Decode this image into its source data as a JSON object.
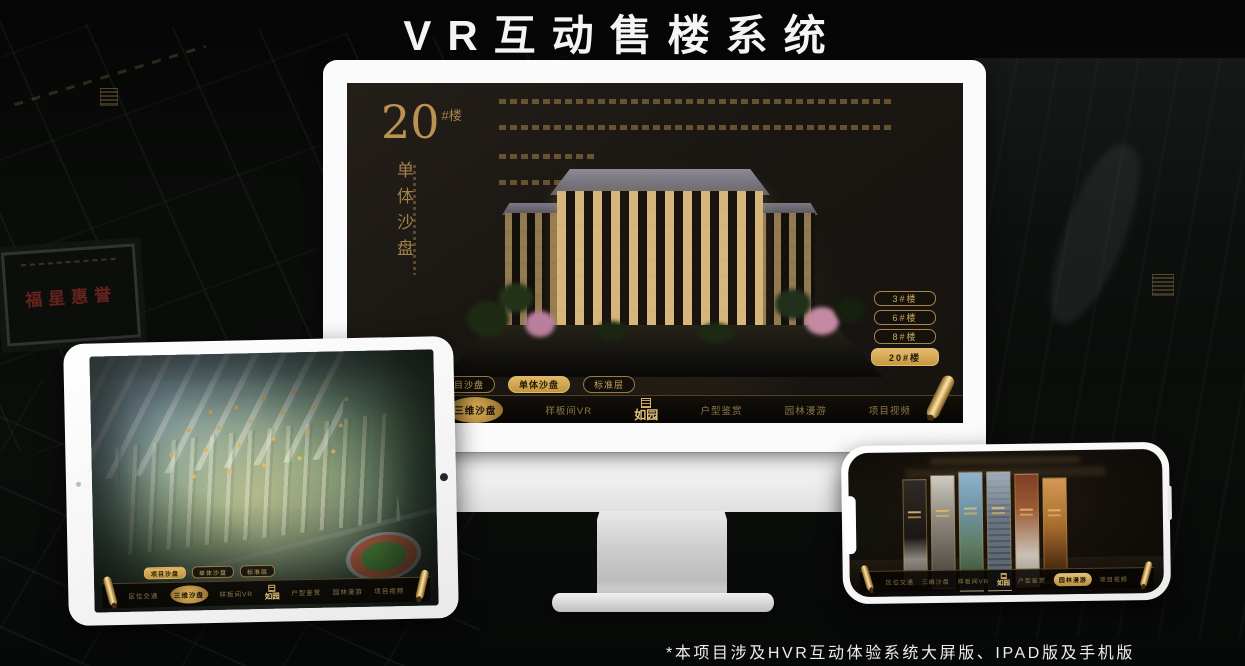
{
  "page": {
    "title": "VR互动售楼系统",
    "footnote": "*本项目涉及HVR互动体验系统大屏版、IPAD版及手机版"
  },
  "colors": {
    "gold": "#d9a84e",
    "gold_text": "#c9a158",
    "screen_bg": "#1b1713",
    "device_white": "#fafafa"
  },
  "background": {
    "plaque_text": "福星惠誉"
  },
  "monitor": {
    "headline_number": "20",
    "headline_unit": "#楼",
    "headline_subtitle": "单体沙盘",
    "floor_buttons": [
      {
        "label": "3#楼",
        "active": false
      },
      {
        "label": "6#楼",
        "active": false
      },
      {
        "label": "8#楼",
        "active": false
      },
      {
        "label": "20#楼",
        "active": true
      }
    ],
    "sub_tabs": [
      {
        "label": "项目沙盘",
        "active": false
      },
      {
        "label": "单体沙盘",
        "active": true
      },
      {
        "label": "标准层",
        "active": false
      }
    ],
    "nav_items": [
      {
        "label": "区位交通",
        "active": false
      },
      {
        "label": "三维沙盘",
        "active": true
      },
      {
        "label": "样板间VR",
        "active": false
      },
      {
        "label": "户型鉴赏",
        "active": false
      },
      {
        "label": "园林漫游",
        "active": false
      },
      {
        "label": "项目视频",
        "active": false
      }
    ],
    "logo": "如园"
  },
  "ipad": {
    "sub_tabs": [
      {
        "label": "项目沙盘",
        "active": true
      },
      {
        "label": "单体沙盘",
        "active": false
      },
      {
        "label": "标准层",
        "active": false
      }
    ],
    "nav_items": [
      {
        "label": "区位交通",
        "active": false
      },
      {
        "label": "三维沙盘",
        "active": true
      },
      {
        "label": "样板间VR",
        "active": false
      },
      {
        "label": "户型鉴赏",
        "active": false
      },
      {
        "label": "园林漫游",
        "active": false
      },
      {
        "label": "项目视频",
        "active": false
      }
    ],
    "logo": "如园"
  },
  "phone": {
    "nav_items": [
      {
        "label": "区位交通",
        "active": false
      },
      {
        "label": "三维沙盘",
        "active": false
      },
      {
        "label": "样板间VR",
        "active": false
      },
      {
        "label": "户型鉴赏",
        "active": false
      },
      {
        "label": "园林漫游",
        "active": true
      },
      {
        "label": "项目视频",
        "active": false
      }
    ],
    "logo": "如园"
  }
}
